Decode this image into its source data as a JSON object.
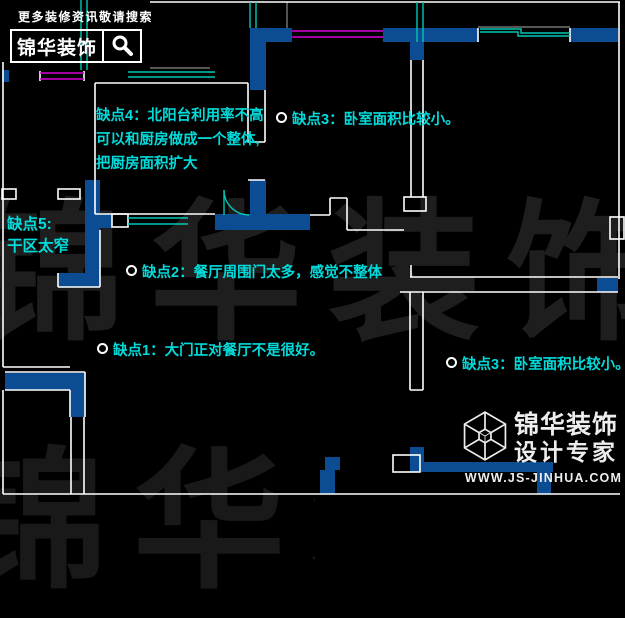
{
  "header_logo": {
    "tagline": "更多装修资讯敬请搜索",
    "brand": "锦华装饰"
  },
  "watermark": {
    "text": "锦华装饰"
  },
  "annotations": {
    "defect4": {
      "lines": [
        "缺点4：北阳台利用率不高",
        "可以和厨房做成一个整体,",
        "把厨房面积扩大"
      ]
    },
    "defect3_top": {
      "text": "缺点3：卧室面积比较小。"
    },
    "defect5": {
      "lines": [
        "缺点5:",
        "干区太窄"
      ]
    },
    "defect2": {
      "text": "缺点2：餐厅周围门太多，感觉不整体"
    },
    "defect1": {
      "text": "缺点1：大门正对餐厅不是很好。"
    },
    "defect3_bottom": {
      "text": "缺点3：卧室面积比较小。"
    }
  },
  "footer_logo": {
    "brand": "锦华装饰",
    "subtitle": "设计专家",
    "url": "WWW.JS-JINHUA.COM"
  },
  "icons": {
    "search": "magnifier-icon",
    "footer": "cube-wireframe-icon",
    "defect_marker": "circle-outline-icon"
  },
  "colors": {
    "background": "#000000",
    "wall_fill_blue": "#0c4c93",
    "annotation_cyan": "#00dcdc",
    "window_teal": "#00c8b4",
    "window_magenta": "#d400d4",
    "wall_line_white": "#ffffff",
    "watermark_gray": "#1e1e1e"
  }
}
